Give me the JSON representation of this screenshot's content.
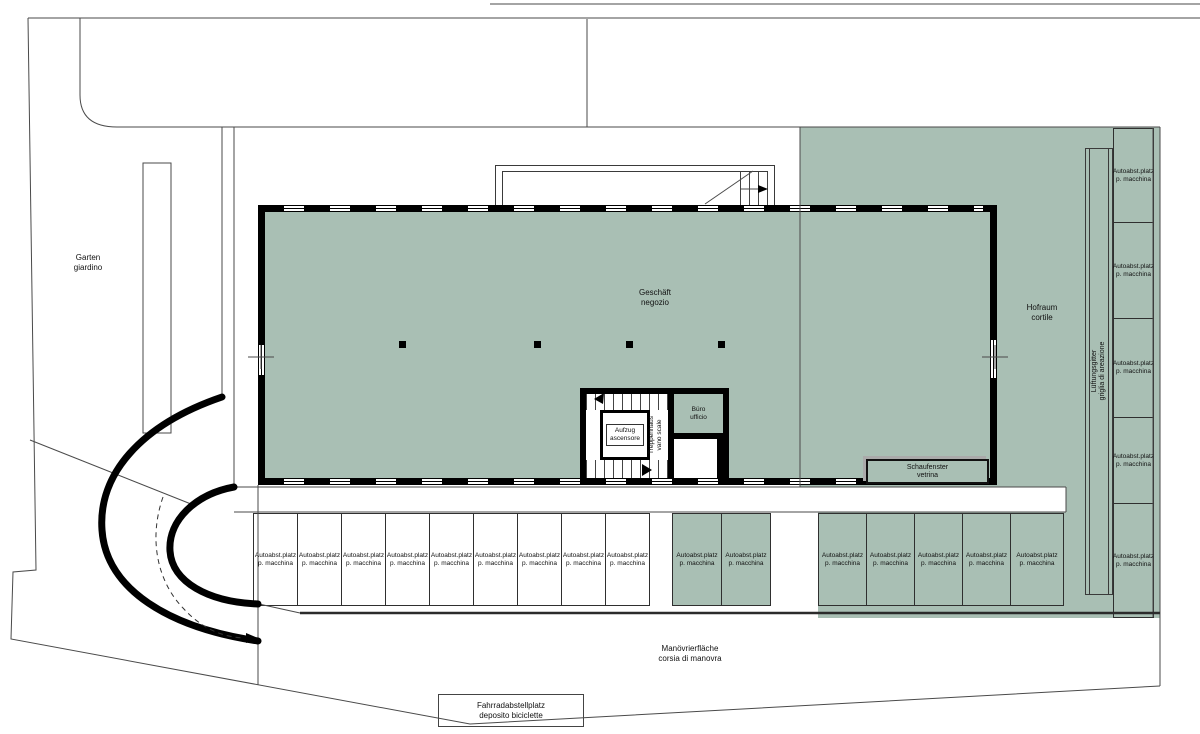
{
  "plan": {
    "garden": {
      "line1": "Garten",
      "line2": "giardino"
    },
    "shop": {
      "line1": "Geschäft",
      "line2": "negozio"
    },
    "courtyard": {
      "line1": "Hofraum",
      "line2": "cortile"
    },
    "vent_grille": {
      "line1": "Lüftungsgitter",
      "line2": "griglia di areazione"
    },
    "office": {
      "line1": "Büro",
      "line2": "ufficio"
    },
    "elevator": {
      "line1": "Aufzug",
      "line2": "ascensore"
    },
    "stairwell": {
      "line1": "Treppenhaus",
      "line2": "vano scale"
    },
    "shop_window": {
      "line1": "Schaufenster",
      "line2": "vetrina"
    },
    "maneuvering": {
      "line1": "Manövrierfläche",
      "line2": "corsia di manovra"
    },
    "bike_storage": {
      "line1": "Fahrradabstellplatz",
      "line2": "deposito biciclette"
    },
    "car_space": {
      "line1": "Autoabst.platz",
      "line2": "p. macchina"
    }
  },
  "counts": {
    "bottom_white_stalls": 9,
    "bottom_green_stalls_left_group": 2,
    "bottom_green_stalls_right_group": 5,
    "right_column_stalls": 5
  },
  "colors": {
    "area_green": "#a9bfb4",
    "wall_black": "#000000",
    "line_gray": "#4a4a4a"
  }
}
